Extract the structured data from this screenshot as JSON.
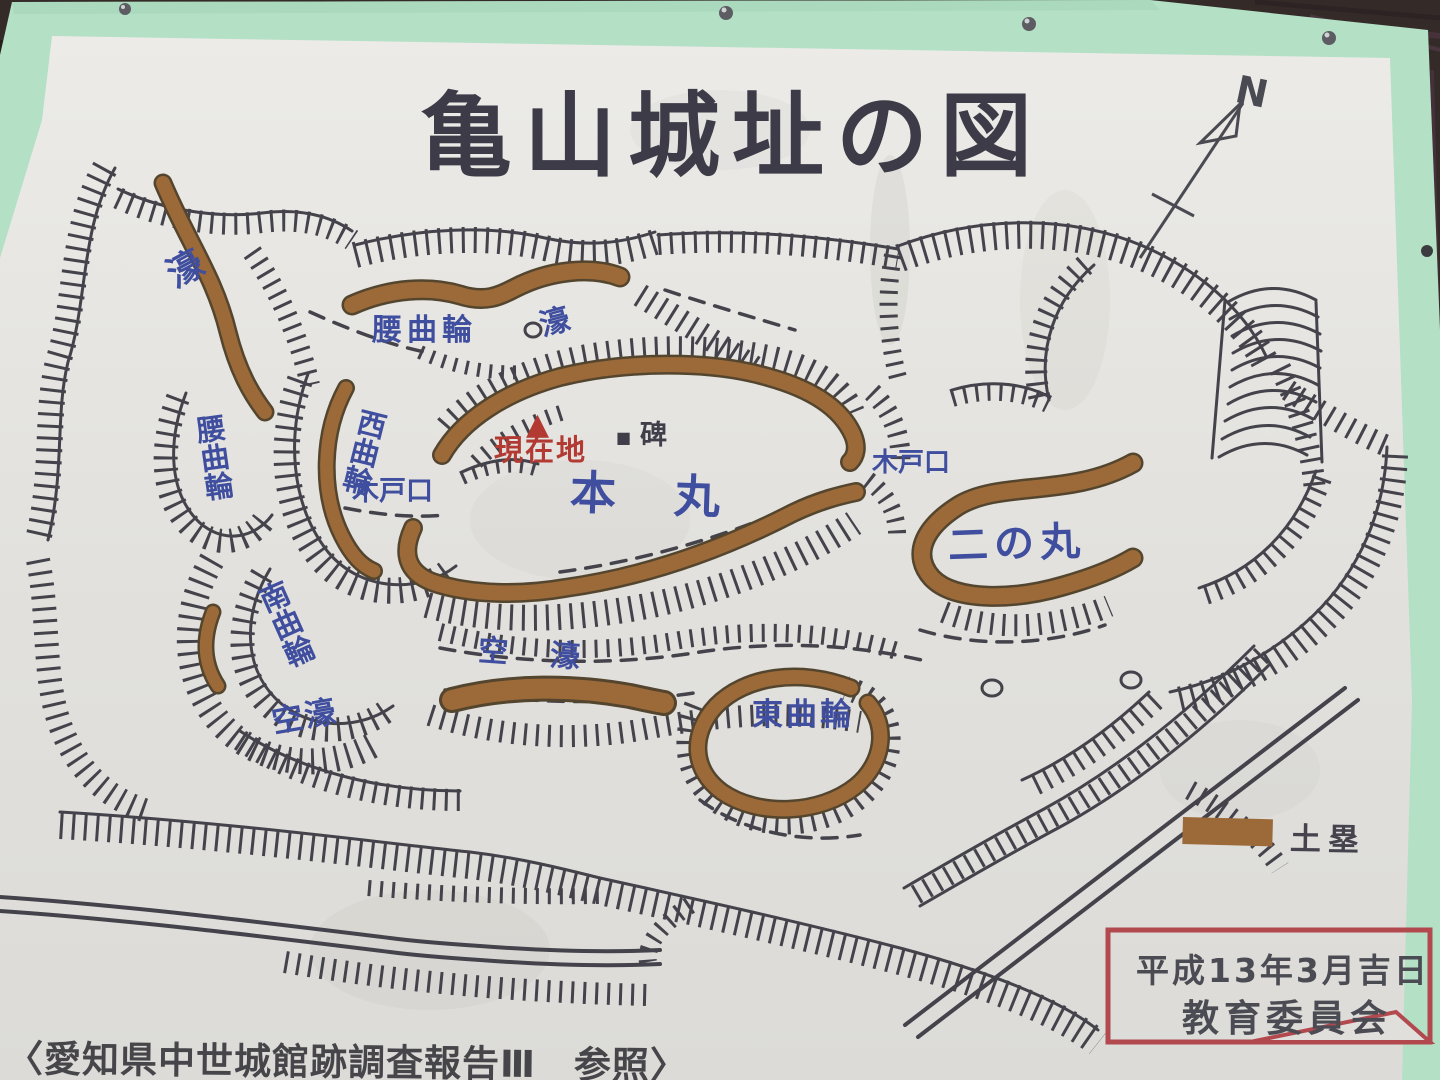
{
  "sign": {
    "title": "亀山城址の図",
    "compass": {
      "north_label": "N"
    },
    "map_labels": {
      "moat_top_left": "濠",
      "koshi_kuruwa_top": "腰曲輪",
      "moat_top_center": "濠",
      "koshi_kuruwa_west": "腰曲輪",
      "nishi_kuruwa": "西曲輪",
      "kido_guchi_west": "木戸口",
      "genzaichi_marker": "▲",
      "genzaichi": "現在地",
      "monument_marker": "■",
      "monument": "碑",
      "honmaru": "本　丸",
      "kido_guchi_east": "木戸口",
      "ninomaru": "二の丸",
      "minami_kuruwa": "南曲輪",
      "karabori_center": "空　濠",
      "karabori_southwest": "空濠",
      "higashi_kuruwa": "東曲輪"
    },
    "legend": {
      "dorui_label": "土塁"
    },
    "date_box": {
      "line1": "平成13年3月吉日",
      "line2": "教育委員会"
    },
    "caption": "〈愛知県中世城館跡調査報告Ⅲ　参照〉",
    "colors": {
      "board_green": "#b4e0c6",
      "paper": "#e4e3df",
      "ink": "#44434b",
      "label_blue": "#3f4e9e",
      "marker_red": "#b23a32",
      "earthwork_brown": "#9c6a38",
      "box_border_red": "#b2494f",
      "wood_dark": "#342ا28"
    }
  }
}
